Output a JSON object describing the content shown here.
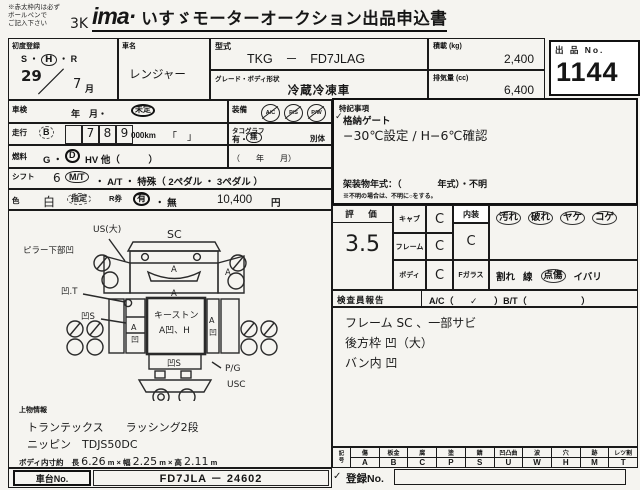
{
  "header": {
    "note_lines": [
      "※赤太枠内は必ず",
      "ボールペンで",
      "ご記入下さい"
    ],
    "hand_mark": "3K",
    "logo": "ima·",
    "title": "いすゞモーターオークション出品申込書"
  },
  "row1": {
    "first_reg": {
      "label": "初度登録",
      "era_pre": "S ・",
      "era_circled": "H",
      "era_post": "・ R",
      "year": "29",
      "slash": "／",
      "month": "7",
      "month_label": "月"
    },
    "car_name": {
      "label": "車名",
      "value": "レンジャー"
    },
    "model": {
      "label": "型式",
      "value": "TKG　－　FD7JLAG"
    },
    "grade": {
      "label": "グレード・ボディ形状",
      "value": "冷蔵冷凍車"
    },
    "payload": {
      "label": "積載 (kg)",
      "value": "2,400"
    },
    "displacement": {
      "label": "排気量 (cc)",
      "value": "6,400"
    },
    "lot": {
      "label": "出 品 No.",
      "value": "1144"
    }
  },
  "specs": {
    "shaken": {
      "label": "車検",
      "text": "年　月・",
      "circled": "未定"
    },
    "equip": {
      "label": "装備",
      "icons": [
        "A/C",
        "P/S",
        "P/W"
      ]
    },
    "mileage": {
      "label": "走行",
      "badge": "B",
      "digits": [
        "",
        "7",
        "8",
        "9"
      ],
      "unit": "000km",
      "brackets": "「　」"
    },
    "tacho": {
      "label": "タコグラフ",
      "options": "有・",
      "circled": "無",
      "extra": "別体",
      "paren": "（　　年　　月）"
    },
    "fuel": {
      "label": "燃料",
      "pre": "G ・",
      "circled": "D",
      "post": "HV 他（　　　）"
    },
    "shift": {
      "label": "シフト",
      "hand": "6",
      "circled": "M/T",
      "rest": "・ A/T ・ 特殊（ 2ペダル ・ 3ペダル ）"
    },
    "color": {
      "label": "色",
      "hand": "白",
      "dashed": "指定",
      "r_label": "R券",
      "circled": "有",
      "rest": "・ 無",
      "price": "10,400",
      "unit": "円"
    }
  },
  "notes": {
    "label": "特記事項",
    "check": "✓",
    "line1": "格納ゲート",
    "line2": "−30℃設定 / H−6℃確認",
    "body_year": "架装物年式：（　　　　年式）・不明",
    "small": "※不明の場合は、不明に○をする。"
  },
  "rating": {
    "label": "評　価",
    "score": "3.5",
    "items": [
      {
        "label": "キャブ",
        "value": "C"
      },
      {
        "label": "フレーム",
        "value": "C"
      },
      {
        "label": "ボディ",
        "value": "C"
      }
    ],
    "interior": {
      "label": "内装",
      "value": "C",
      "k1": "汚れ",
      "k2": "破れ",
      "k3": "ヤケ",
      "k4": "コゲ"
    },
    "glass": {
      "label": "Fガラス",
      "k1": "割れ",
      "k2": "線",
      "k3": "点傷",
      "k4": "イバリ"
    }
  },
  "report": {
    "label": "検査員報告",
    "ac_pre": "A/C（",
    "ac_check": "✓",
    "mid": "）B/T（",
    "end": "）",
    "lines": [
      "フレーム SC 、一部サビ",
      "後方枠 凹（大）",
      "バン内 凹"
    ]
  },
  "legend": {
    "first_top": "記",
    "first_bottom": "号",
    "cols": [
      [
        "傷",
        "A"
      ],
      [
        "板金",
        "B"
      ],
      [
        "腐",
        "C"
      ],
      [
        "塗",
        "P"
      ],
      [
        "錆",
        "S"
      ],
      [
        "凹凸曲",
        "U"
      ],
      [
        "波",
        "W"
      ],
      [
        "穴",
        "H"
      ],
      [
        "跡",
        "M"
      ],
      [
        "レツ割",
        "T"
      ]
    ]
  },
  "bottom": {
    "superstructure_label": "上物情報",
    "lines": [
      "トランテックス　　ラッシング2段",
      "ニッピン　TDJS50DC"
    ],
    "inner_dim": {
      "label": "ボディ内寸約",
      "l_label": "長",
      "l": "6.26",
      "l_unit": "m ×",
      "w_label": "幅",
      "w": "2.25",
      "w_unit": "m ×",
      "h_label": "高",
      "h": "2.11",
      "h_unit": "m"
    },
    "chassis": {
      "label": "車台No.",
      "value": "FD7JLA － 24602"
    },
    "reg": {
      "check": "✓",
      "label": "登録No."
    }
  },
  "diagram": {
    "sc": "SC",
    "us_big": "US(大)",
    "pillar": "ピラー下部凹",
    "ut": "凹.T",
    "us_side": "凹S",
    "a": "A",
    "u": "凹",
    "keystone": "キーストン",
    "keystone2": "A凹、H",
    "rear": "凹S",
    "pg": "P/G",
    "usc": "USC"
  }
}
